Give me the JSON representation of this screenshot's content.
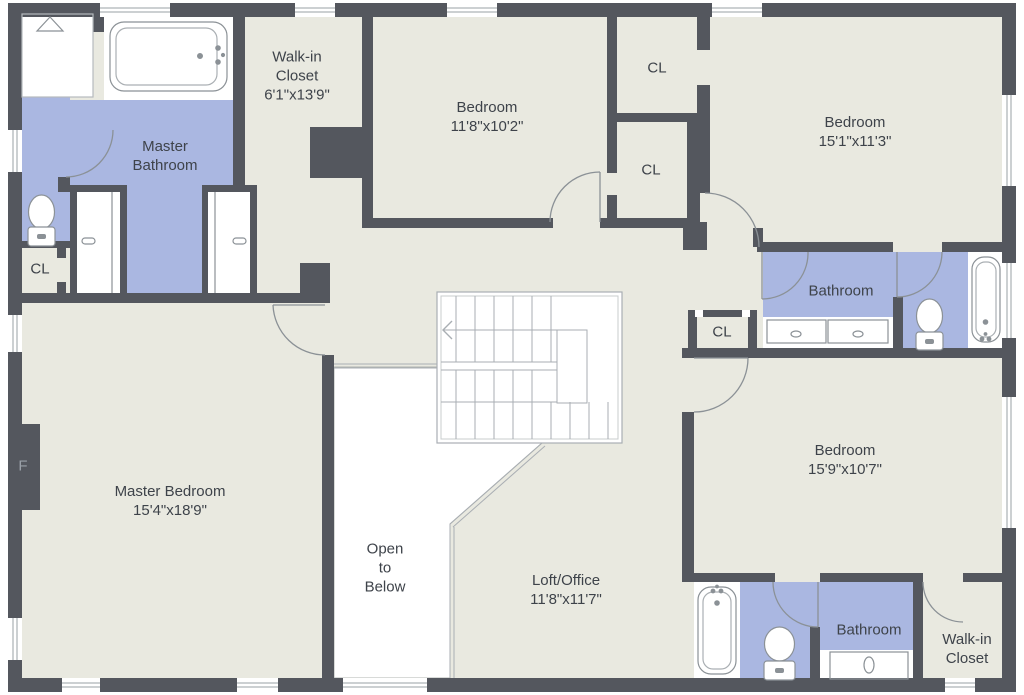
{
  "colors": {
    "wall": "#54575e",
    "floor": "#e9e9e0",
    "bathroom_floor": "#aab7e1",
    "fixture_line": "#8b9196",
    "stair_line": "#a9aeb3",
    "label_text": "#3e434a",
    "furnace_text": "#9aa0a8",
    "background": "#ffffff"
  },
  "rooms": {
    "walk_in_closet_top": {
      "name": "Walk-in\nCloset",
      "dims": "6'1\"x13'9\""
    },
    "master_bathroom": {
      "name": "Master\nBathroom",
      "dims": ""
    },
    "bedroom_top": {
      "name": "Bedroom",
      "dims": "11'8\"x10'2\""
    },
    "closet_a": {
      "name": "CL",
      "dims": ""
    },
    "closet_b": {
      "name": "CL",
      "dims": ""
    },
    "bedroom_right": {
      "name": "Bedroom",
      "dims": "15'1\"x11'3\""
    },
    "bathroom_top": {
      "name": "Bathroom",
      "dims": ""
    },
    "closet_hall": {
      "name": "CL",
      "dims": ""
    },
    "closet_master": {
      "name": "CL",
      "dims": ""
    },
    "master_bedroom": {
      "name": "Master Bedroom",
      "dims": "15'4\"x18'9\""
    },
    "open_to_below": {
      "name": "Open\nto\nBelow",
      "dims": ""
    },
    "loft_office": {
      "name": "Loft/Office",
      "dims": "11'8\"x11'7\""
    },
    "bedroom_bottom": {
      "name": "Bedroom",
      "dims": "15'9\"x10'7\""
    },
    "bathroom_bottom": {
      "name": "Bathroom",
      "dims": ""
    },
    "walk_in_closet_bottom": {
      "name": "Walk-in\nCloset",
      "dims": ""
    },
    "furnace": {
      "name": "F",
      "dims": ""
    }
  }
}
